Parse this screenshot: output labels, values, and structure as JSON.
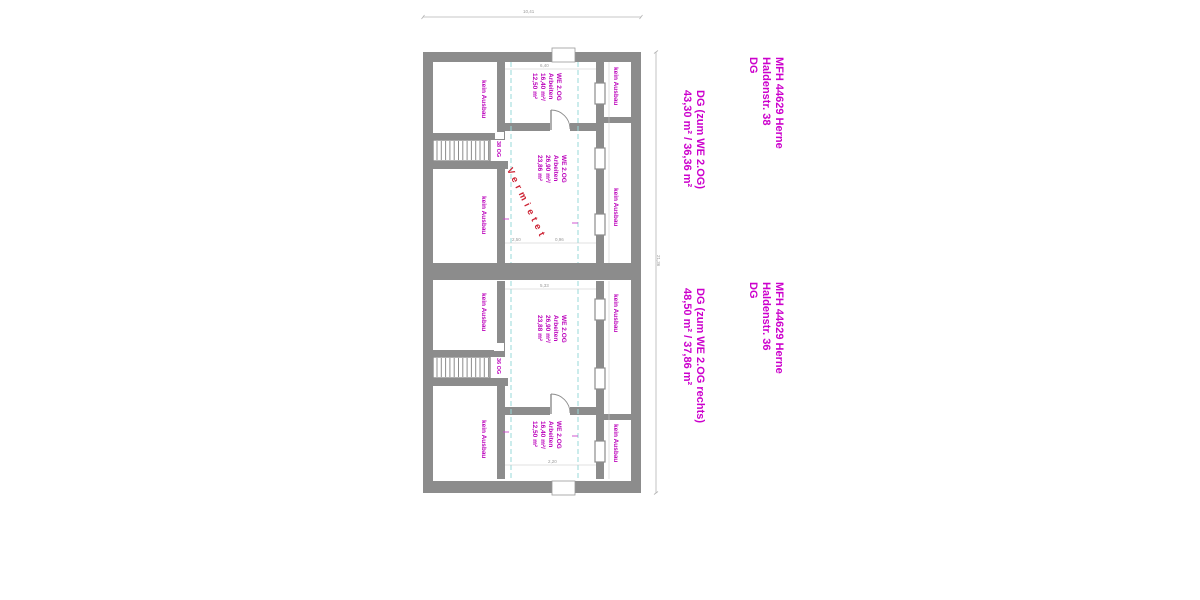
{
  "colors": {
    "wall": "#8c8c8c",
    "annotation_magenta": "#cc00cc",
    "plan_magenta": "#bb00bb",
    "vermietet_red": "#cc2233",
    "roof_dash_teal": "#97d8d8",
    "dimension_gray": "#999999"
  },
  "annotations": {
    "unit38": {
      "title_lines": [
        "MFH 44629 Herne",
        "Haldenstr. 38",
        "DG"
      ],
      "area_lines": [
        "DG (zum WE 2.OG)",
        "43,30 m² / 36,36 m²"
      ]
    },
    "unit36": {
      "title_lines": [
        "MFH 44629 Herne",
        "Haldenstr. 36",
        "DG"
      ],
      "area_lines": [
        "DG (zum WE 2.OG rechts)",
        "48,50 m² / 37,86 m²"
      ]
    }
  },
  "plan": {
    "kein_ausbau_label": "kein Ausbau",
    "vermietet_label": "Vermietet",
    "unit38": {
      "stair_label": "38 OG",
      "room_small_lines": [
        "WE 2.OG",
        "Arbeiten",
        "16,40 m²/",
        "12,50 m²"
      ],
      "room_big_lines": [
        "WE 2.OG",
        "Arbeiten",
        "26,90 m²/",
        "23,86 m²"
      ]
    },
    "unit36": {
      "stair_label": "36 OG",
      "room_big_lines": [
        "WE 2.OG",
        "Arbeiten",
        "26,90 m²/",
        "23,88 m²"
      ],
      "room_small_lines": [
        "WE 2.OG",
        "Arbeiten",
        "16,40 m²/",
        "12,50 m²"
      ]
    },
    "dimensions": {
      "total_width": "10,41",
      "total_height": "21,36",
      "room_small_width": "6,40",
      "room_big_width": "5,33",
      "dim_left": "2,50",
      "dim_right": "0,96",
      "dim_bottom": "2,20"
    }
  }
}
